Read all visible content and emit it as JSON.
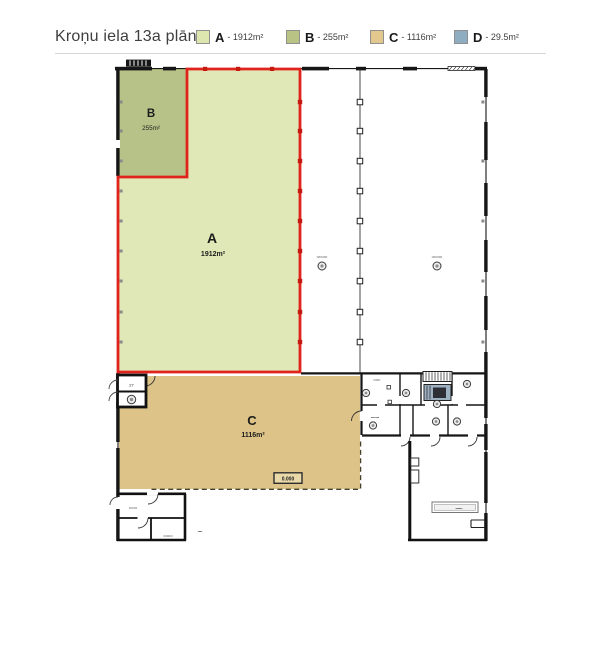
{
  "header": {
    "title": "Kroņu iela 13a plāns",
    "legend": [
      {
        "label": "A",
        "area": "- 1912m²",
        "color": "#dce6ae"
      },
      {
        "label": "B",
        "area": "- 255m²",
        "color": "#b9c383"
      },
      {
        "label": "C",
        "area": "- 1116m²",
        "color": "#e2c88e"
      },
      {
        "label": "D",
        "area": "- 29.5m²",
        "color": "#8fadc0"
      }
    ]
  },
  "plan": {
    "sections": {
      "A": {
        "label": "A",
        "area": "1912m²",
        "fill": "#dfe8b6",
        "outline": "#e0231c"
      },
      "B": {
        "label": "B",
        "area": "255m²",
        "fill": "#b6c287"
      },
      "C": {
        "label": "C",
        "area": "1116m²",
        "fill": "#ddc387"
      },
      "D": {
        "label": "D",
        "area": "29.5m²",
        "fill": "#9db1c2"
      }
    },
    "annotations": {
      "room_number": "27",
      "elevation_mark": "0.000",
      "hall1_note": "•••••••••",
      "hall2_note": "•••••••••",
      "office_note_top": "••••••",
      "office_note_left": "•••••••",
      "room_bl_note_top": "•••••••",
      "room_bl_note_bottom": "••••••••",
      "outside_note": "••••",
      "strip_box_note": "••••••"
    }
  }
}
